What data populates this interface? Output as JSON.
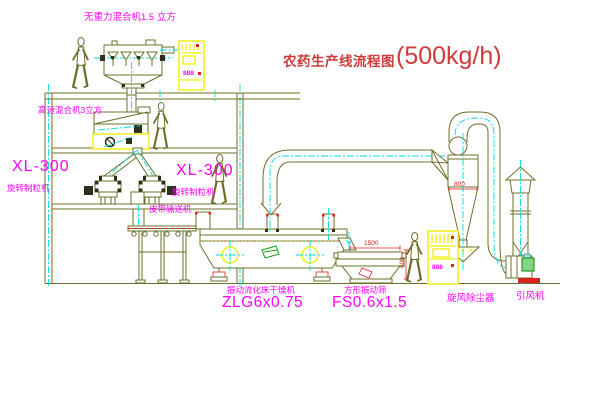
{
  "title": {
    "text_cn": "农药生产线流程图",
    "capacity": "(500kg/h)"
  },
  "machines": {
    "gravity_mixer": {
      "label": "无重力混合机1.5 立方"
    },
    "high_speed_mixer": {
      "label": "高速混合机3立方"
    },
    "granulator_left": {
      "model": "XL-300",
      "name": "旋转制粒机"
    },
    "granulator_mid": {
      "model": "XL-300",
      "name": "旋转制粒机"
    },
    "belt_conveyor": {
      "name": "皮带输送机"
    },
    "fluid_bed_dryer": {
      "name": "振动流化床干燥机",
      "model": "ZLG6x0.75"
    },
    "vibrating_sieve": {
      "name": "方形振动筛",
      "model": "FS0.6x1.5",
      "dim_width": "1500",
      "dim_height": "600"
    },
    "cyclone": {
      "name": "旋风除尘器",
      "dim_diameter": "800"
    },
    "fan": {
      "name": "引风机"
    },
    "cabinet_top": {
      "display": "888"
    },
    "cabinet_right": {
      "display": "888"
    }
  },
  "colors": {
    "line": "#6f6f2d",
    "centerline": "#00dcdc",
    "label": "#ff00ff",
    "highlight": "#f0f000",
    "dimension": "#dd2222",
    "title": "#cf3a3a",
    "motor_green": "#18a018",
    "background": "#ffffff"
  }
}
